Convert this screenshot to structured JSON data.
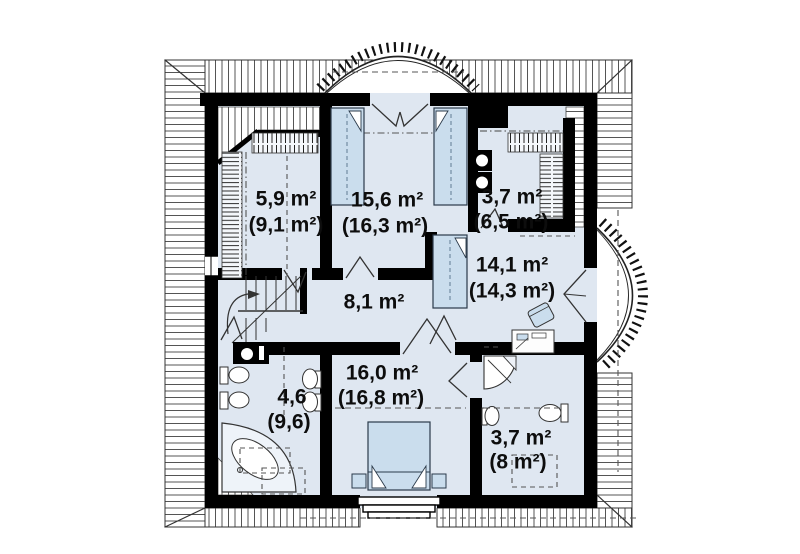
{
  "plan": {
    "title": "attic-floor-plan",
    "rooms": [
      {
        "name": "wardrobe-top-left",
        "area": "5,9 m²",
        "area_total": "(9,1 m²)"
      },
      {
        "name": "bedroom-top",
        "area": "15,6 m²",
        "area_total": "(16,3 m²)"
      },
      {
        "name": "wardrobe-top-right",
        "area": "3,7 m²",
        "area_total": "(6,5 m²)"
      },
      {
        "name": "bedroom-right",
        "area": "14,1 m²",
        "area_total": "(14,3 m²)"
      },
      {
        "name": "hall",
        "area": "8,1 m²",
        "area_total": ""
      },
      {
        "name": "bathroom-left",
        "area": "4,6",
        "area_total": "(9,6)"
      },
      {
        "name": "bedroom-bottom",
        "area": "16,0 m²",
        "area_total": "(16,8 m²)"
      },
      {
        "name": "bathroom-right",
        "area": "3,7 m²",
        "area_total": "(8 m²)"
      }
    ],
    "colors": {
      "wall": "#000000",
      "floor": "#dfe7f1",
      "furniture": "#cadded",
      "hatch_line": "#555555",
      "background": "#ffffff",
      "label": "#0d0d0d"
    }
  }
}
